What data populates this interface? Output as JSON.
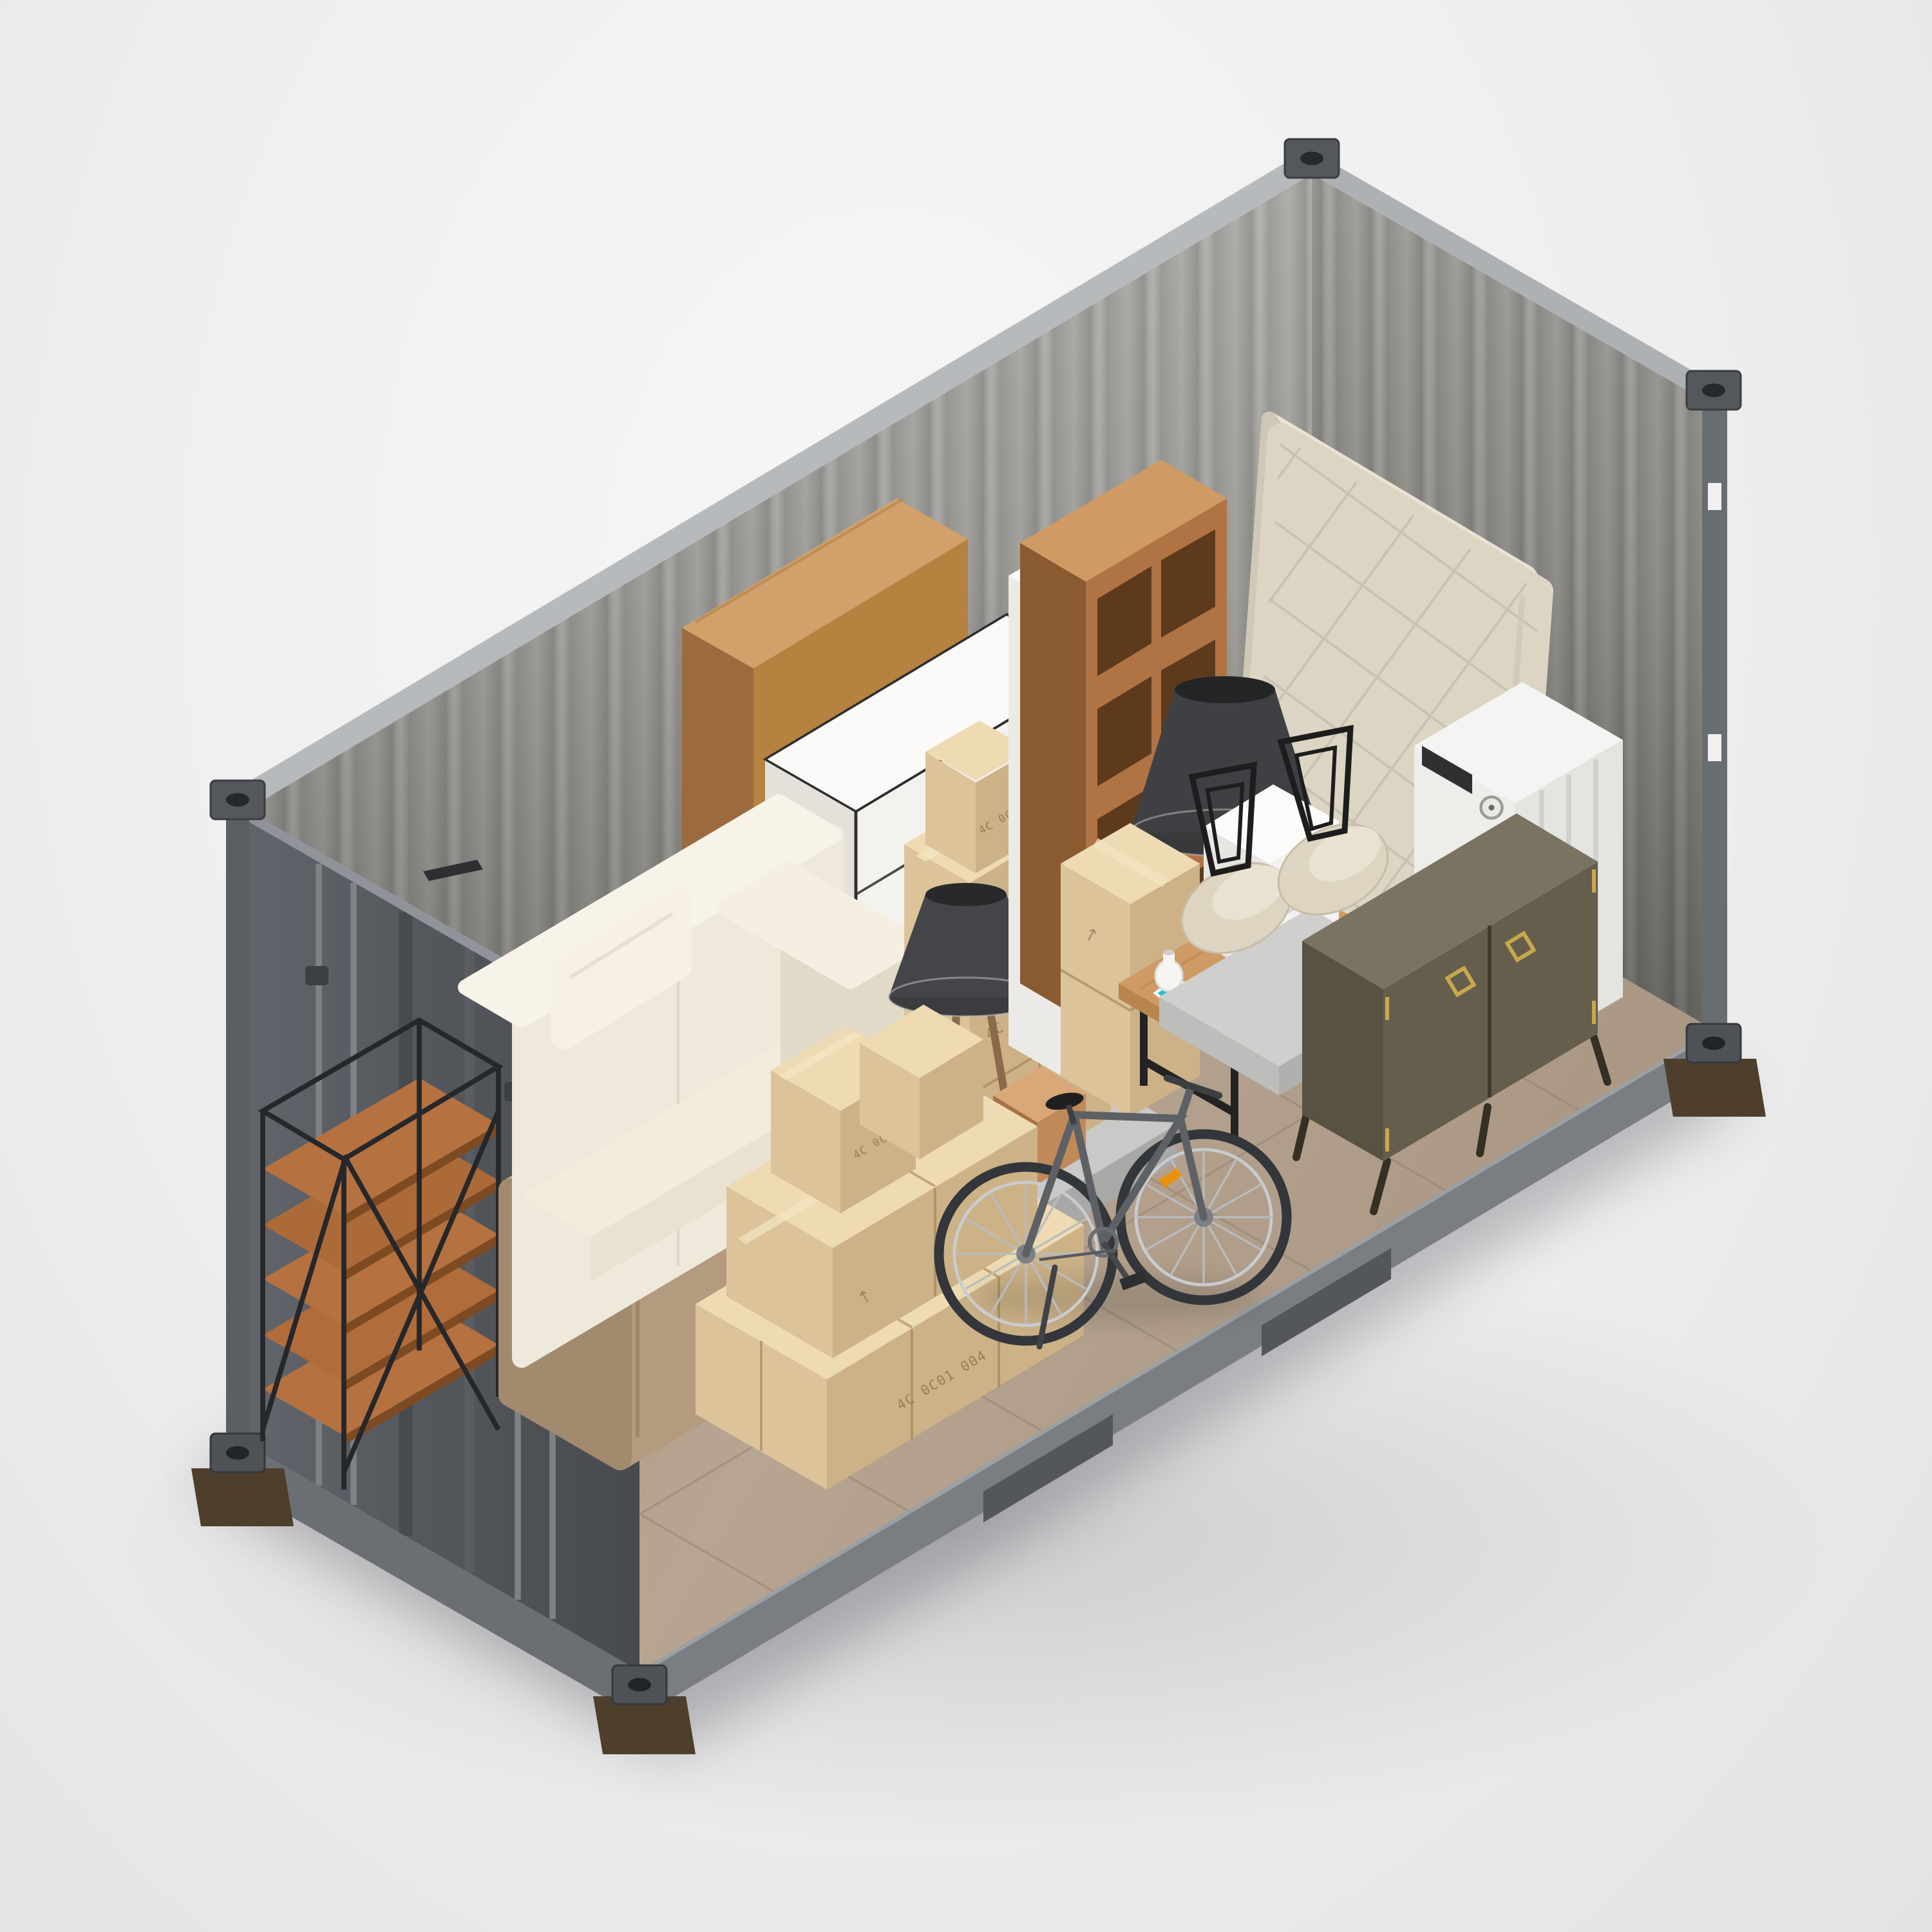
{
  "scene": {
    "description": "Isometric 3D cutaway of a gray shipping container used as a self-storage unit, packed with household furniture, appliances and cardboard moving boxes on a neutral studio background",
    "view": "isometric cutaway, open front side",
    "background_color": "#f0f0f1"
  },
  "palette": {
    "container_exterior": "#565b60",
    "container_interior_wall": "#96948f",
    "container_rail": "#7a7e82",
    "container_rim": "#b7babc",
    "floor_tan": "#b3a08c",
    "cardboard_top": "#eedbb4",
    "cardboard_front": "#cdb288",
    "cardboard_side": "#dcc39a",
    "sofa_cream": "#efe9db",
    "mattress_cream": "#dcd5c3",
    "wood_warm": "#b5713f",
    "wood_light": "#c08a58",
    "metal_black": "#2b2b2b",
    "appliance_white": "#f2f2f0",
    "sideboard_olive": "#655e4c",
    "brass_gold": "#c9a84c",
    "wicker_amber": "#b08440",
    "resin_teal": "#2fc0d2"
  },
  "boxes": {
    "label": "4C 0C01 004",
    "arrow": "↑"
  },
  "items": [
    {
      "id": "shipping-container",
      "label": "Gray shipping container shell (cutaway)"
    },
    {
      "id": "metal-shelving",
      "label": "Black metal shelving unit with wood shelves"
    },
    {
      "id": "armchair-flipped",
      "label": "Taupe armchair turned on its back"
    },
    {
      "id": "sofa",
      "label": "Cream fabric sofa"
    },
    {
      "id": "tripod-floor-lamp",
      "label": "Tripod floor lamp with dark shade"
    },
    {
      "id": "wardrobe",
      "label": "Light wood wardrobe"
    },
    {
      "id": "white-dresser",
      "label": "White chest of drawers"
    },
    {
      "id": "wicker-tower",
      "label": "White shelf tower with wicker baskets"
    },
    {
      "id": "cube-bookshelf",
      "label": "Wooden cube bookshelf"
    },
    {
      "id": "mattress",
      "label": "Quilted mattress leaning on end wall"
    },
    {
      "id": "cone-table-lamp",
      "label": "Large dark cone lamp shade"
    },
    {
      "id": "coffee-table",
      "label": "Wood coffee table with black metal legs"
    },
    {
      "id": "mini-nightstand",
      "label": "Small white nightstand"
    },
    {
      "id": "vase",
      "label": "Small white vase"
    },
    {
      "id": "shell-chairs",
      "label": "Two cream shell chairs stacked upside down"
    },
    {
      "id": "washing-machine",
      "label": "White front-load washing machine"
    },
    {
      "id": "sideboard",
      "label": "Olive sideboard with brass handles"
    },
    {
      "id": "bicycle",
      "label": "Gray bicycle"
    },
    {
      "id": "box-stacks",
      "label": "Stacks of kraft cardboard moving boxes"
    }
  ]
}
